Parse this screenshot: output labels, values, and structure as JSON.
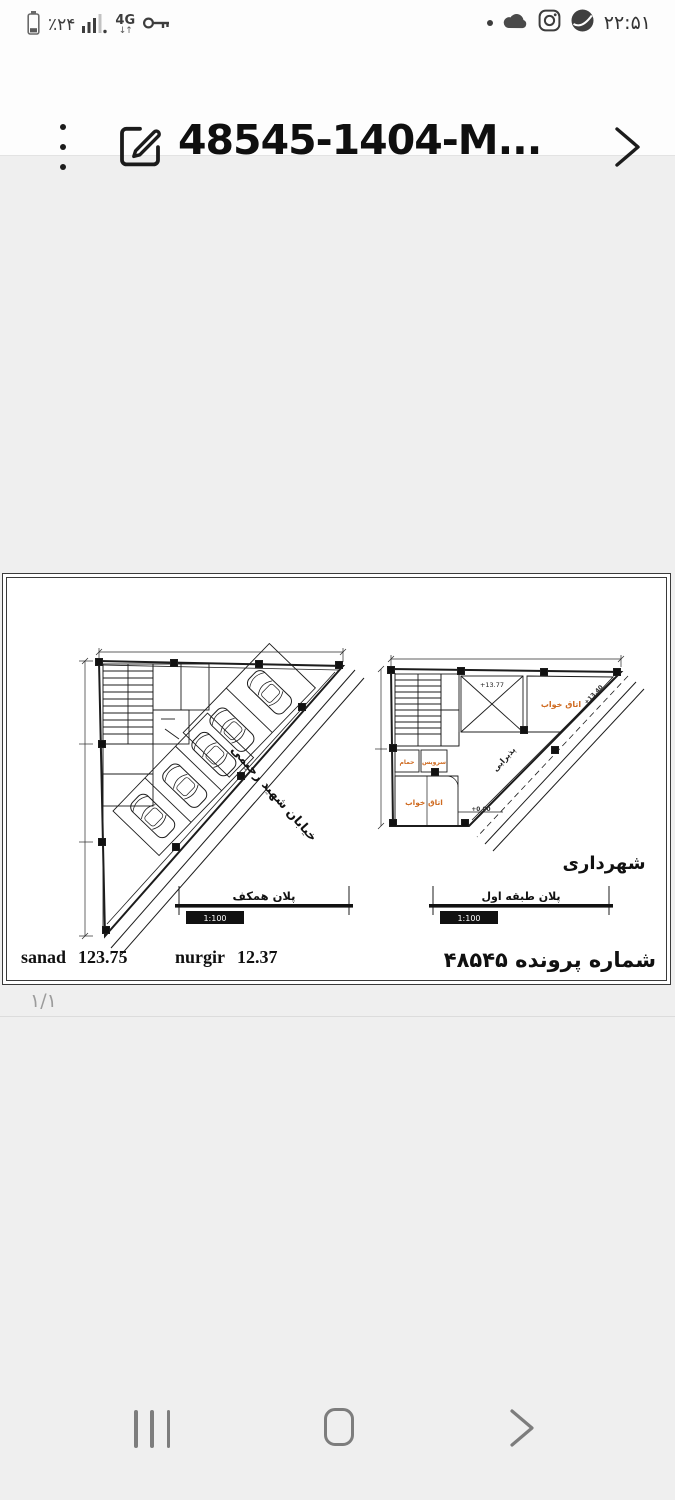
{
  "status_bar": {
    "battery_percent": "٪۲۴",
    "network_label": "4G",
    "network_arrows": "↓↑",
    "time": "۲۲:۵۱"
  },
  "header": {
    "title": "48545-1404-M..."
  },
  "document": {
    "scale_stamp": "1:100",
    "left_plan": {
      "title": "پلان همکف",
      "street_name": "خیابان شهید رحیمی"
    },
    "right_plan": {
      "title": "پلان طبقه اول",
      "municipality": "شهرداری",
      "living_room": "پذیرایی",
      "room_top_right": "اتاق خواب",
      "room_bath": "حمام",
      "room_wc": "سرویس",
      "room_bed": "اتاق خواب",
      "elev_void": "+13.77",
      "elev_road": "+13.40",
      "elev_ground": "+0.00"
    },
    "footer": {
      "sanad_label": "sanad",
      "sanad_value": "123.75",
      "nurgir_label": "nurgir",
      "nurgir_value": "12.37",
      "file_label": "شماره پرونده",
      "file_number": "۴۸۵۴۵"
    }
  },
  "pager": {
    "page": "۱/۱"
  },
  "colors": {
    "room_label_orange": "#cf6b21",
    "drawing_line": "#1c1c1c",
    "page_background": "#efefef"
  }
}
